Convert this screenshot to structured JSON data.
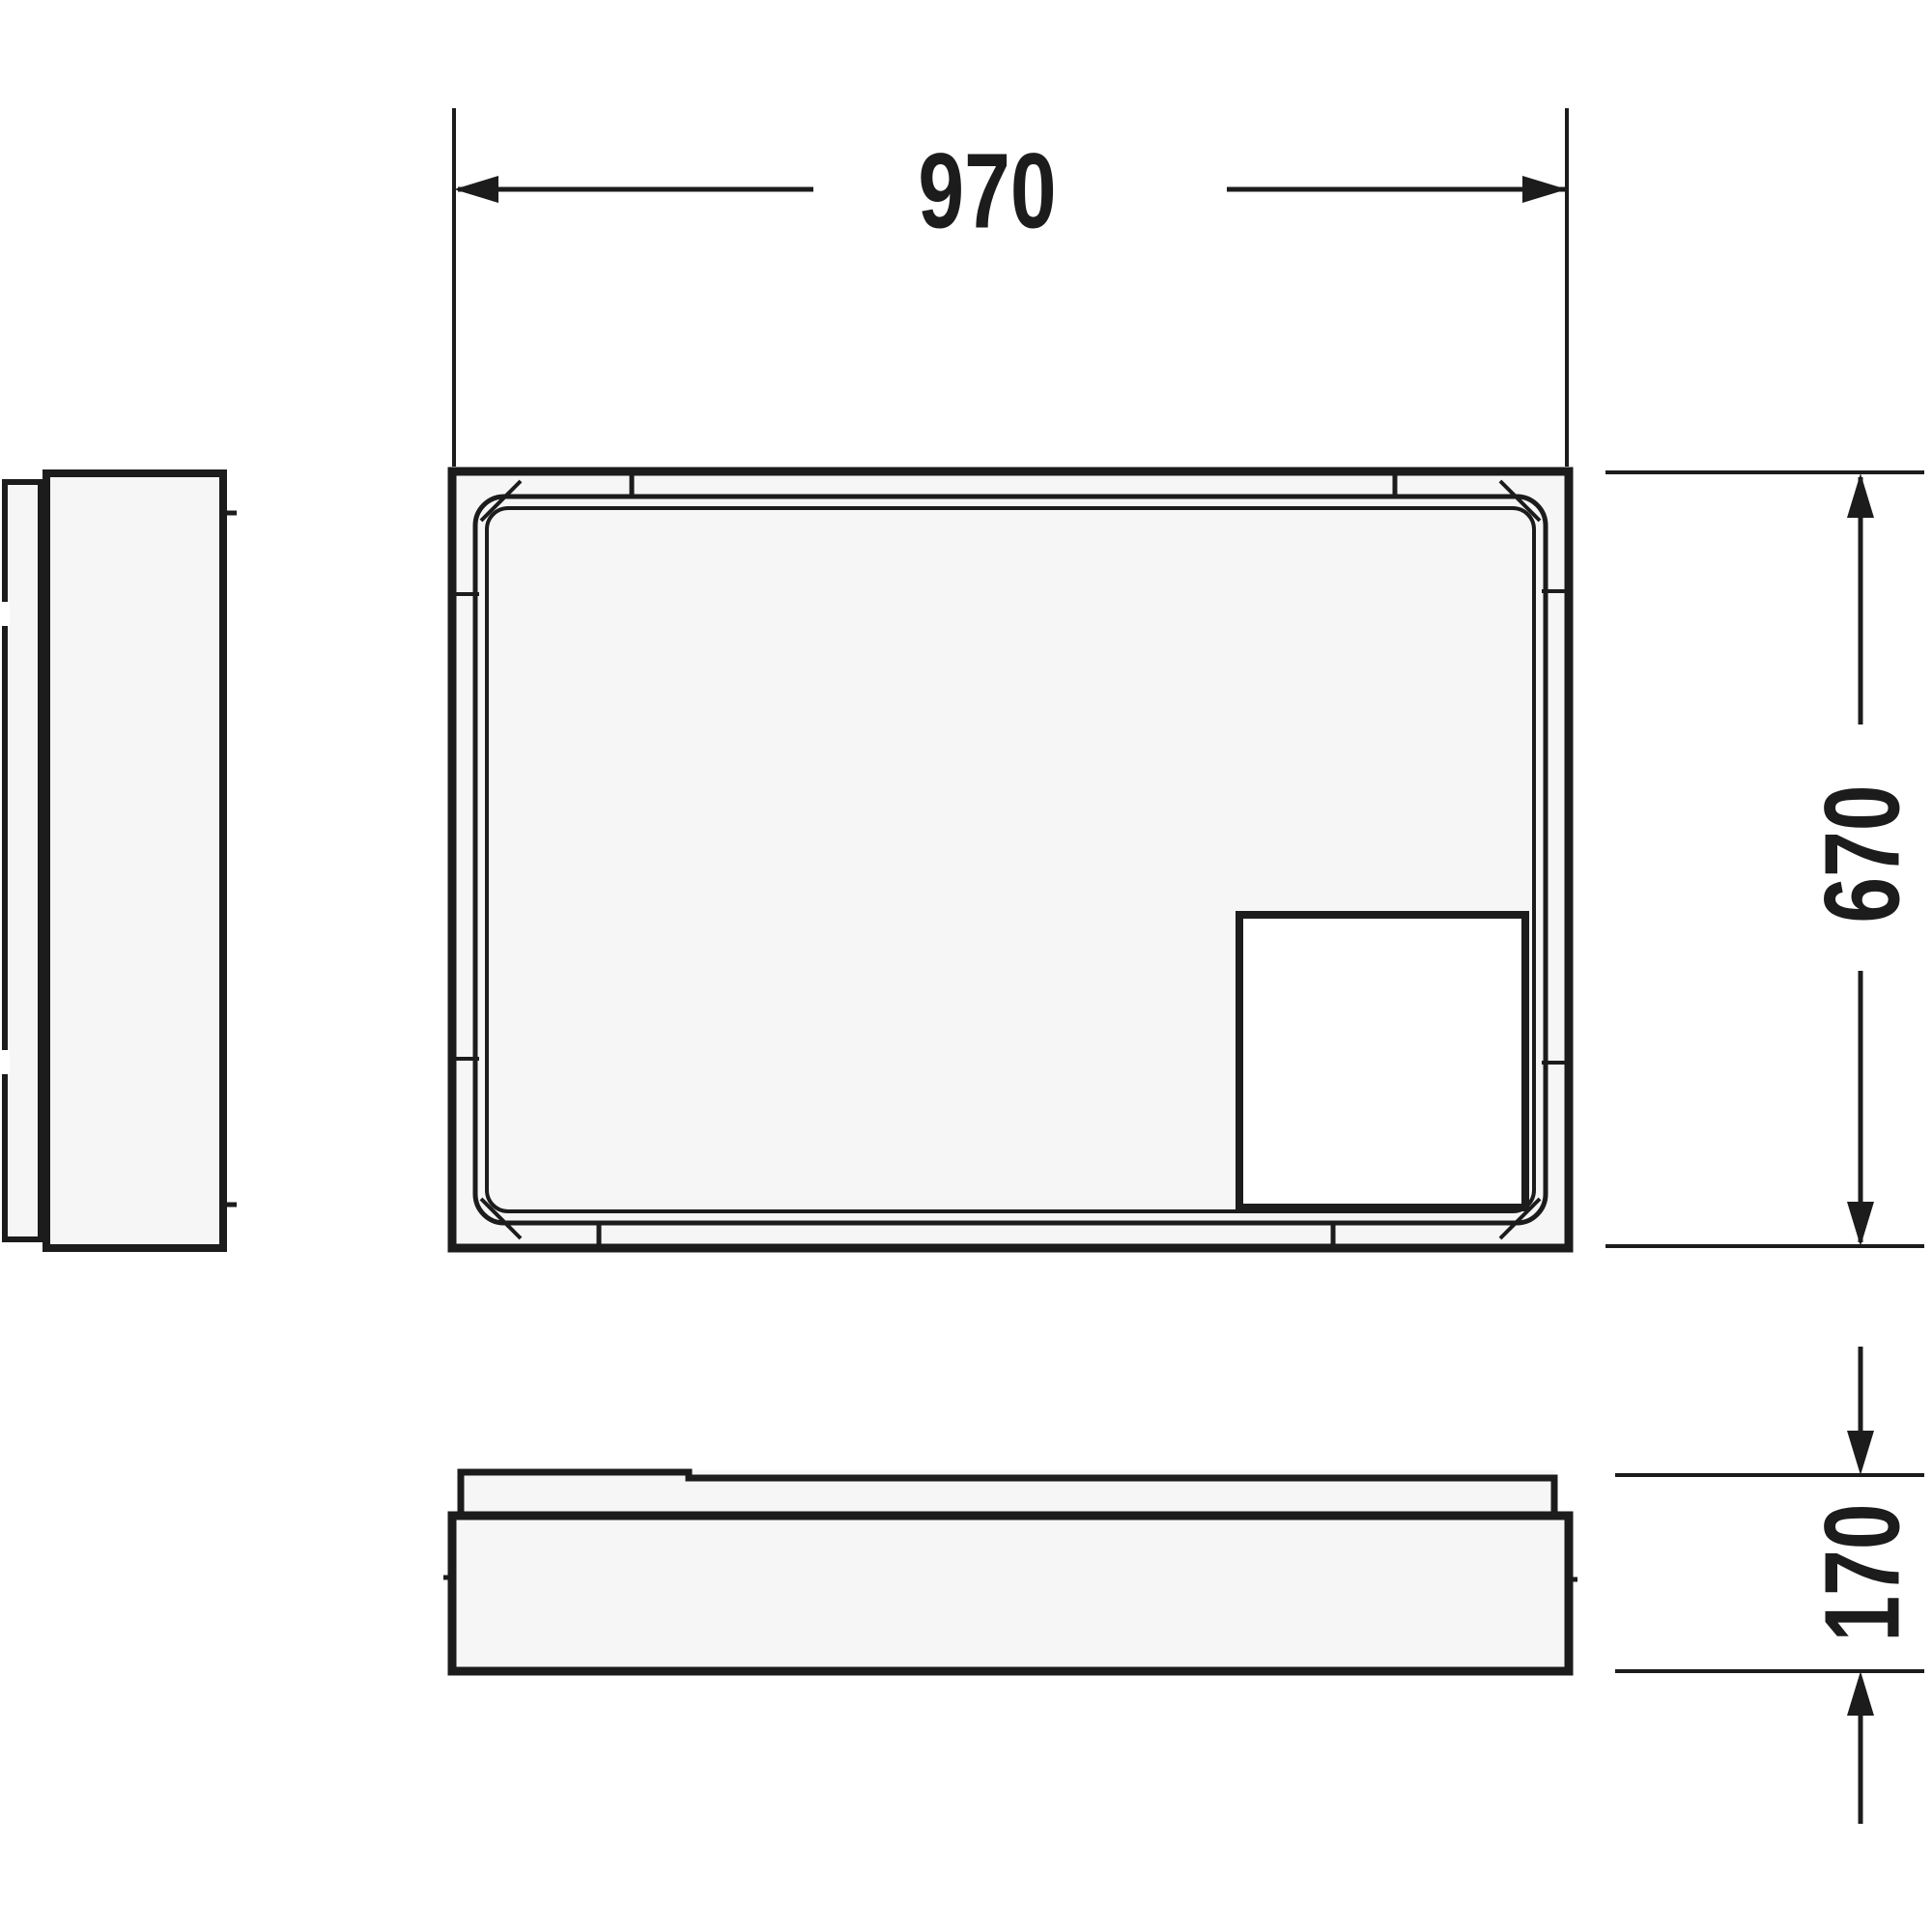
{
  "diagram": {
    "type": "technical-dimension-drawing",
    "subject": "rectangular shower tray with support frame, plan view, side view and front elevation",
    "colors": {
      "background": "#ffffff",
      "line": "#1c1c1c",
      "panel_fill": "#f6f6f6",
      "cutout_fill": "#ffffff"
    },
    "dimensions": {
      "width": {
        "value": "970",
        "orientation": "horizontal",
        "location": "top"
      },
      "depth": {
        "value": "670",
        "orientation": "vertical",
        "location": "right of plan view"
      },
      "height": {
        "value": "170",
        "orientation": "vertical",
        "location": "right of front elevation"
      }
    }
  }
}
